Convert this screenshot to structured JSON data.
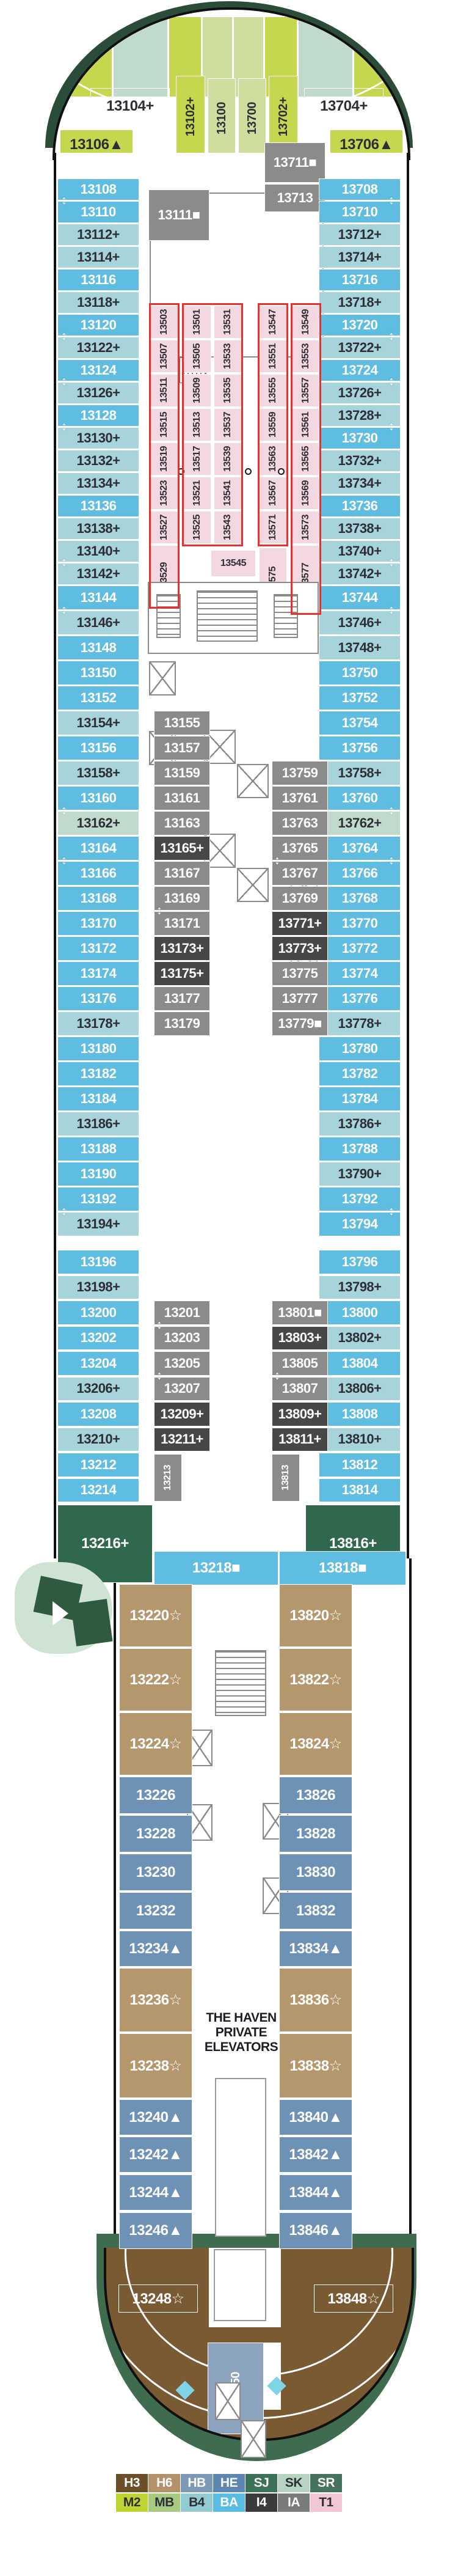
{
  "palette": {
    "BA": {
      "bg": "#5fbde2",
      "fg": "#ffffff"
    },
    "B4": {
      "bg": "#a7d3da",
      "fg": "#2e2e36"
    },
    "SK": {
      "bg": "#c0dbcd",
      "fg": "#2e2e36"
    },
    "M2": {
      "bg": "#c5d64f",
      "fg": "#2e2e36"
    },
    "MB": {
      "bg": "#cfdd9e",
      "fg": "#2e2e36"
    },
    "SJ": {
      "bg": "#30684d",
      "fg": "#ffffff"
    },
    "T1": {
      "bg": "#f4d8e1",
      "fg": "#2e2e36"
    },
    "IA": {
      "bg": "#8b8b8b",
      "fg": "#ffffff"
    },
    "I4": {
      "bg": "#474747",
      "fg": "#ffffff"
    },
    "H6": {
      "bg": "#b4976c",
      "fg": "#ffffff"
    },
    "HE": {
      "bg": "#6e92b6",
      "fg": "#ffffff"
    },
    "H3": {
      "bg": "#6b4e2c",
      "fg": "#ffffff"
    },
    "HB": {
      "bg": "#8ba3bc",
      "fg": "#ffffff"
    },
    "studio_outline": "#e8312e"
  },
  "bow": {
    "band_cats": [
      "M2",
      "SK",
      "M2",
      "MB",
      "MB",
      "M2",
      "SK",
      "M2"
    ],
    "cabins": [
      {
        "label": "13104+",
        "cat": "SK"
      },
      {
        "label": "13102+",
        "cat": "M2",
        "v": 1
      },
      {
        "label": "13100",
        "cat": "MB",
        "v": 1
      },
      {
        "label": "13700",
        "cat": "MB",
        "v": 1
      },
      {
        "label": "13702+",
        "cat": "M2",
        "v": 1
      },
      {
        "label": "13704+",
        "cat": "SK"
      }
    ],
    "wings": [
      {
        "label": "13106▲",
        "cat": "M2"
      },
      {
        "label": "13706▲",
        "cat": "M2"
      }
    ]
  },
  "port_column": [
    {
      "label": "13108",
      "cat": "BA",
      "arrow": true
    },
    {
      "label": "13110",
      "cat": "BA"
    },
    {
      "label": "13112+",
      "cat": "B4"
    },
    {
      "label": "13114+",
      "cat": "B4"
    },
    {
      "label": "13116",
      "cat": "BA"
    },
    {
      "label": "13118+",
      "cat": "B4"
    },
    {
      "label": "13120",
      "cat": "BA",
      "arrow": true
    },
    {
      "label": "13122+",
      "cat": "B4"
    },
    {
      "label": "13124",
      "cat": "BA",
      "arrow": true
    },
    {
      "label": "13126+",
      "cat": "B4"
    },
    {
      "label": "13128",
      "cat": "BA",
      "arrow": true
    },
    {
      "label": "13130+",
      "cat": "B4"
    },
    {
      "label": "13132+",
      "cat": "B4"
    },
    {
      "label": "13134+",
      "cat": "B4"
    },
    {
      "label": "13136",
      "cat": "BA"
    },
    {
      "label": "13138+",
      "cat": "B4"
    },
    {
      "label": "13140+",
      "cat": "B4",
      "arrow": true
    },
    {
      "label": "13142+",
      "cat": "B4"
    },
    {
      "label": "13144",
      "cat": "BA",
      "arrow": true
    },
    {
      "label": "13146+",
      "cat": "B4"
    },
    {
      "label": "13148",
      "cat": "BA"
    },
    {
      "label": "13150",
      "cat": "BA"
    },
    {
      "label": "13152",
      "cat": "BA"
    },
    {
      "label": "13154+",
      "cat": "B4"
    },
    {
      "label": "13156",
      "cat": "BA"
    },
    {
      "label": "13158+",
      "cat": "B4"
    },
    {
      "label": "13160",
      "cat": "BA",
      "arrow": true
    },
    {
      "label": "13162+",
      "cat": "SK"
    },
    {
      "label": "13164",
      "cat": "BA",
      "arrow": true
    },
    {
      "label": "13166",
      "cat": "BA"
    },
    {
      "label": "13168",
      "cat": "BA"
    },
    {
      "label": "13170",
      "cat": "BA"
    },
    {
      "label": "13172",
      "cat": "BA"
    },
    {
      "label": "13174",
      "cat": "BA"
    },
    {
      "label": "13176",
      "cat": "BA"
    },
    {
      "label": "13178+",
      "cat": "B4"
    },
    {
      "label": "13180",
      "cat": "BA"
    },
    {
      "label": "13182",
      "cat": "BA"
    },
    {
      "label": "13184",
      "cat": "BA"
    },
    {
      "label": "13186+",
      "cat": "B4"
    },
    {
      "label": "13188",
      "cat": "BA"
    },
    {
      "label": "13190",
      "cat": "BA"
    },
    {
      "label": "13192",
      "cat": "BA",
      "arrow": true
    },
    {
      "label": "13194+",
      "cat": "B4"
    },
    {
      "label": "13196",
      "cat": "BA"
    },
    {
      "label": "13198+",
      "cat": "B4"
    },
    {
      "label": "13200",
      "cat": "BA"
    },
    {
      "label": "13202",
      "cat": "BA"
    },
    {
      "label": "13204",
      "cat": "BA"
    },
    {
      "label": "13206+",
      "cat": "B4"
    },
    {
      "label": "13208",
      "cat": "BA"
    },
    {
      "label": "13210+",
      "cat": "B4"
    },
    {
      "label": "13212",
      "cat": "BA"
    },
    {
      "label": "13214",
      "cat": "BA"
    }
  ],
  "starboard_column": [
    {
      "label": "13708",
      "cat": "BA",
      "arrow": true
    },
    {
      "label": "13710",
      "cat": "BA"
    },
    {
      "label": "13712+",
      "cat": "B4"
    },
    {
      "label": "13714+",
      "cat": "B4"
    },
    {
      "label": "13716",
      "cat": "BA"
    },
    {
      "label": "13718+",
      "cat": "B4"
    },
    {
      "label": "13720",
      "cat": "BA",
      "arrow": true
    },
    {
      "label": "13722+",
      "cat": "B4"
    },
    {
      "label": "13724",
      "cat": "BA",
      "arrow": true
    },
    {
      "label": "13726+",
      "cat": "B4"
    },
    {
      "label": "13728+",
      "cat": "B4",
      "arrow": true
    },
    {
      "label": "13730",
      "cat": "BA"
    },
    {
      "label": "13732+",
      "cat": "B4"
    },
    {
      "label": "13734+",
      "cat": "B4"
    },
    {
      "label": "13736",
      "cat": "BA"
    },
    {
      "label": "13738+",
      "cat": "B4"
    },
    {
      "label": "13740+",
      "cat": "B4",
      "arrow": true
    },
    {
      "label": "13742+",
      "cat": "B4"
    },
    {
      "label": "13744",
      "cat": "BA",
      "arrow": true
    },
    {
      "label": "13746+",
      "cat": "B4"
    },
    {
      "label": "13748+",
      "cat": "B4"
    },
    {
      "label": "13750",
      "cat": "BA"
    },
    {
      "label": "13752",
      "cat": "BA"
    },
    {
      "label": "13754",
      "cat": "BA"
    },
    {
      "label": "13756",
      "cat": "BA"
    },
    {
      "label": "13758+",
      "cat": "B4"
    },
    {
      "label": "13760",
      "cat": "BA",
      "arrow": true
    },
    {
      "label": "13762+",
      "cat": "SK"
    },
    {
      "label": "13764",
      "cat": "BA",
      "arrow": true
    },
    {
      "label": "13766",
      "cat": "BA"
    },
    {
      "label": "13768",
      "cat": "BA"
    },
    {
      "label": "13770",
      "cat": "BA"
    },
    {
      "label": "13772",
      "cat": "BA"
    },
    {
      "label": "13774",
      "cat": "BA"
    },
    {
      "label": "13776",
      "cat": "BA"
    },
    {
      "label": "13778+",
      "cat": "B4"
    },
    {
      "label": "13780",
      "cat": "BA"
    },
    {
      "label": "13782",
      "cat": "BA"
    },
    {
      "label": "13784",
      "cat": "BA"
    },
    {
      "label": "13786+",
      "cat": "B4"
    },
    {
      "label": "13788",
      "cat": "BA"
    },
    {
      "label": "13790+",
      "cat": "B4"
    },
    {
      "label": "13792",
      "cat": "BA",
      "arrow": true
    },
    {
      "label": "13794",
      "cat": "BA"
    },
    {
      "label": "13796",
      "cat": "BA"
    },
    {
      "label": "13798+",
      "cat": "B4"
    },
    {
      "label": "13800",
      "cat": "BA"
    },
    {
      "label": "13802+",
      "cat": "B4"
    },
    {
      "label": "13804",
      "cat": "BA"
    },
    {
      "label": "13806+",
      "cat": "B4"
    },
    {
      "label": "13808",
      "cat": "BA"
    },
    {
      "label": "13810+",
      "cat": "B4"
    },
    {
      "label": "13812",
      "cat": "BA"
    },
    {
      "label": "13814",
      "cat": "BA"
    }
  ],
  "suites_aft_upper": [
    {
      "label": "13216+",
      "cat": "SJ"
    },
    {
      "label": "13816+",
      "cat": "SJ"
    }
  ],
  "inner_forward": [
    {
      "label": "13111■",
      "cat": "IA"
    },
    {
      "label": "13711■",
      "cat": "IA"
    },
    {
      "label": "13713",
      "cat": "IA"
    }
  ],
  "studios": {
    "cat": "T1",
    "columns": [
      [
        "13503",
        "13507",
        "13511",
        "13515",
        "13519",
        "13523",
        "13527",
        "13529"
      ],
      [
        "13501",
        "13505",
        "13509",
        "13513",
        "13517",
        "13521",
        "13525"
      ],
      [
        "13531",
        "13533",
        "13535",
        "13537",
        "13539",
        "13541",
        "13543"
      ],
      [
        "13547",
        "13551",
        "13555",
        "13559",
        "13563",
        "13567",
        "13571"
      ],
      [
        "13549",
        "13553",
        "13557",
        "13561",
        "13565",
        "13569",
        "13573",
        "13577"
      ]
    ],
    "island": [
      {
        "label": "13545"
      },
      {
        "label": "13575",
        "v": 1
      }
    ]
  },
  "inner_mid_port": [
    {
      "label": "13155",
      "cat": "IA"
    },
    {
      "label": "13157",
      "cat": "IA"
    },
    {
      "label": "13159",
      "cat": "IA"
    },
    {
      "label": "13161",
      "cat": "IA"
    },
    {
      "label": "13163",
      "cat": "IA"
    },
    {
      "label": "13165+",
      "cat": "I4"
    },
    {
      "label": "13167",
      "cat": "IA"
    },
    {
      "label": "13169",
      "cat": "IA",
      "arrow": true
    },
    {
      "label": "13171",
      "cat": "IA"
    },
    {
      "label": "13173+",
      "cat": "I4"
    },
    {
      "label": "13175+",
      "cat": "I4"
    },
    {
      "label": "13177",
      "cat": "IA"
    },
    {
      "label": "13179",
      "cat": "IA"
    }
  ],
  "inner_mid_starboard": [
    {
      "label": "13759",
      "cat": "IA"
    },
    {
      "label": "13761",
      "cat": "IA"
    },
    {
      "label": "13763",
      "cat": "IA"
    },
    {
      "label": "13765",
      "cat": "IA",
      "arrow": true
    },
    {
      "label": "13767",
      "cat": "IA"
    },
    {
      "label": "13769",
      "cat": "IA"
    },
    {
      "label": "13771+",
      "cat": "I4"
    },
    {
      "label": "13773+",
      "cat": "I4"
    },
    {
      "label": "13775",
      "cat": "IA"
    },
    {
      "label": "13777",
      "cat": "IA"
    },
    {
      "label": "13779■",
      "cat": "IA"
    }
  ],
  "inner_aft_port": [
    {
      "label": "13201",
      "cat": "IA",
      "arrow": true
    },
    {
      "label": "13203",
      "cat": "IA"
    },
    {
      "label": "13205",
      "cat": "IA",
      "arrow": true
    },
    {
      "label": "13207",
      "cat": "IA"
    },
    {
      "label": "13209+",
      "cat": "I4"
    },
    {
      "label": "13211+",
      "cat": "I4"
    },
    {
      "label": "13213",
      "cat": "IA",
      "v": 1
    }
  ],
  "inner_aft_starboard": [
    {
      "label": "13801■",
      "cat": "IA"
    },
    {
      "label": "13803+",
      "cat": "I4"
    },
    {
      "label": "13805",
      "cat": "IA",
      "arrow": true
    },
    {
      "label": "13807",
      "cat": "IA"
    },
    {
      "label": "13809+",
      "cat": "I4"
    },
    {
      "label": "13811+",
      "cat": "I4"
    },
    {
      "label": "13813",
      "cat": "IA",
      "v": 1
    }
  ],
  "gateway": [
    {
      "label": "13218■",
      "cat": "BA"
    },
    {
      "label": "13818■",
      "cat": "BA"
    }
  ],
  "haven": {
    "port": [
      {
        "label": "13220☆",
        "cat": "H6"
      },
      {
        "label": "13222☆",
        "cat": "H6"
      },
      {
        "label": "13224☆",
        "cat": "H6"
      },
      {
        "label": "13226",
        "cat": "HE"
      },
      {
        "label": "13228",
        "cat": "HE"
      },
      {
        "label": "13230",
        "cat": "HE"
      },
      {
        "label": "13232",
        "cat": "HE"
      },
      {
        "label": "13234▲",
        "cat": "HE"
      },
      {
        "label": "13236☆",
        "cat": "H6"
      },
      {
        "label": "13238☆",
        "cat": "H6"
      },
      {
        "label": "13240▲",
        "cat": "HE"
      },
      {
        "label": "13242▲",
        "cat": "HE"
      },
      {
        "label": "13244▲",
        "cat": "HE"
      },
      {
        "label": "13246▲",
        "cat": "HE"
      }
    ],
    "starboard": [
      {
        "label": "13820☆",
        "cat": "H6"
      },
      {
        "label": "13822☆",
        "cat": "H6"
      },
      {
        "label": "13824☆",
        "cat": "H6"
      },
      {
        "label": "13826",
        "cat": "HE"
      },
      {
        "label": "13828",
        "cat": "HE"
      },
      {
        "label": "13830",
        "cat": "HE"
      },
      {
        "label": "13832",
        "cat": "HE"
      },
      {
        "label": "13834▲",
        "cat": "HE"
      },
      {
        "label": "13836☆",
        "cat": "H6"
      },
      {
        "label": "13838☆",
        "cat": "H6"
      },
      {
        "label": "13840▲",
        "cat": "HE"
      },
      {
        "label": "13842▲",
        "cat": "HE"
      },
      {
        "label": "13844▲",
        "cat": "HE"
      },
      {
        "label": "13846▲",
        "cat": "HE"
      }
    ],
    "elevator_label": "THE HAVEN PRIVATE ELEVATORS",
    "stern": [
      {
        "label": "13248☆",
        "cat": "H3"
      },
      {
        "label": "13848☆",
        "cat": "H3"
      },
      {
        "label": "13850",
        "cat": "HB",
        "v": 1
      }
    ]
  },
  "legend": {
    "row1": [
      {
        "code": "H3",
        "bg": "#6a4f28",
        "fg": "#ffffff"
      },
      {
        "code": "H6",
        "bg": "#b3916b",
        "fg": "#ffffff"
      },
      {
        "code": "HB",
        "bg": "#7e99b5",
        "fg": "#ffffff"
      },
      {
        "code": "HE",
        "bg": "#5d86b2",
        "fg": "#ffffff"
      },
      {
        "code": "SJ",
        "bg": "#3c7258",
        "fg": "#ffffff"
      },
      {
        "code": "SK",
        "bg": "#b7d3c2",
        "fg": "#2e2e36"
      },
      {
        "code": "SR",
        "bg": "#47725f",
        "fg": "#ffffff"
      }
    ],
    "row2": [
      {
        "code": "M2",
        "bg": "#bed52f",
        "fg": "#2e2e36"
      },
      {
        "code": "MB",
        "bg": "#a6cb80",
        "fg": "#2e2e36"
      },
      {
        "code": "B4",
        "bg": "#92cbd4",
        "fg": "#2e2e36"
      },
      {
        "code": "BA",
        "bg": "#59bce4",
        "fg": "#ffffff"
      },
      {
        "code": "I4",
        "bg": "#3b3b3b",
        "fg": "#ffffff"
      },
      {
        "code": "IA",
        "bg": "#7b7b7b",
        "fg": "#ffffff"
      },
      {
        "code": "T1",
        "bg": "#f3c6d4",
        "fg": "#2e2e36"
      }
    ]
  }
}
